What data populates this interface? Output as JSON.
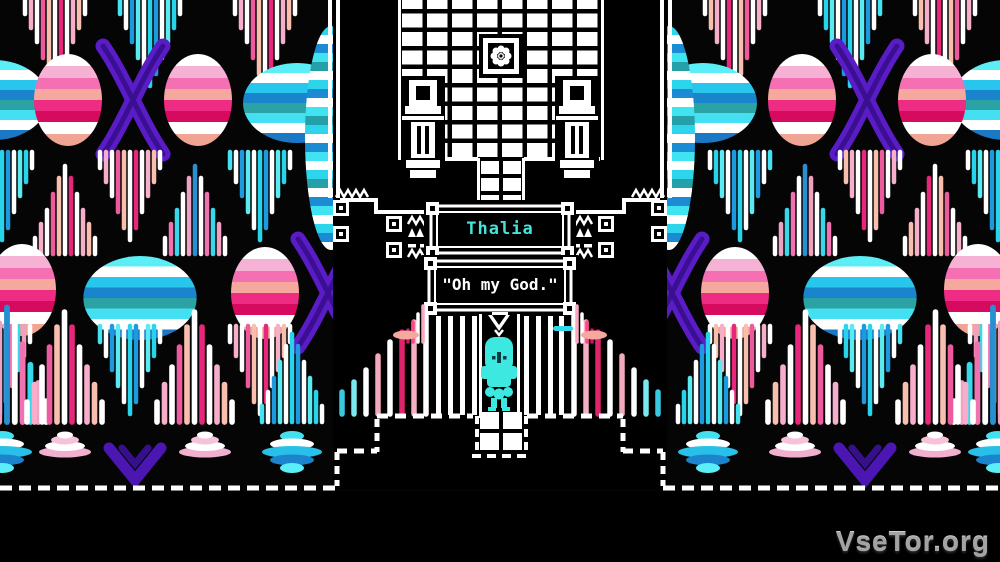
{
  "window": {
    "type": "game-screenshot"
  },
  "dialogue": {
    "speaker_name": "Thalia",
    "speaker_name_color": "#46e3da",
    "message": "\"Oh my God.\""
  },
  "scene": {
    "player_sprite": "cyan-robed-figure",
    "player_sprite_color": "#3ce8e0",
    "temple": {
      "floor": "white-checker-grid",
      "emblem": "flower-emblem",
      "statues": 2,
      "line_color": "#ffffff"
    },
    "background": "psychedelic-ikat-pattern",
    "palette": {
      "black": "#050505",
      "white": "#ffffff",
      "pink": "#f470b2",
      "hot_pink": "#ee2c84",
      "crimson": "#d60a5e",
      "salmon": "#f4a89e",
      "light_pink": "#f6b2d4",
      "cyan": "#3ce0f0",
      "blue": "#1a84cc",
      "teal": "#2ba2a4",
      "purple": "#5a1cc6"
    }
  },
  "watermark": {
    "text": "VseTor.org",
    "color": "#a3a3a3"
  }
}
